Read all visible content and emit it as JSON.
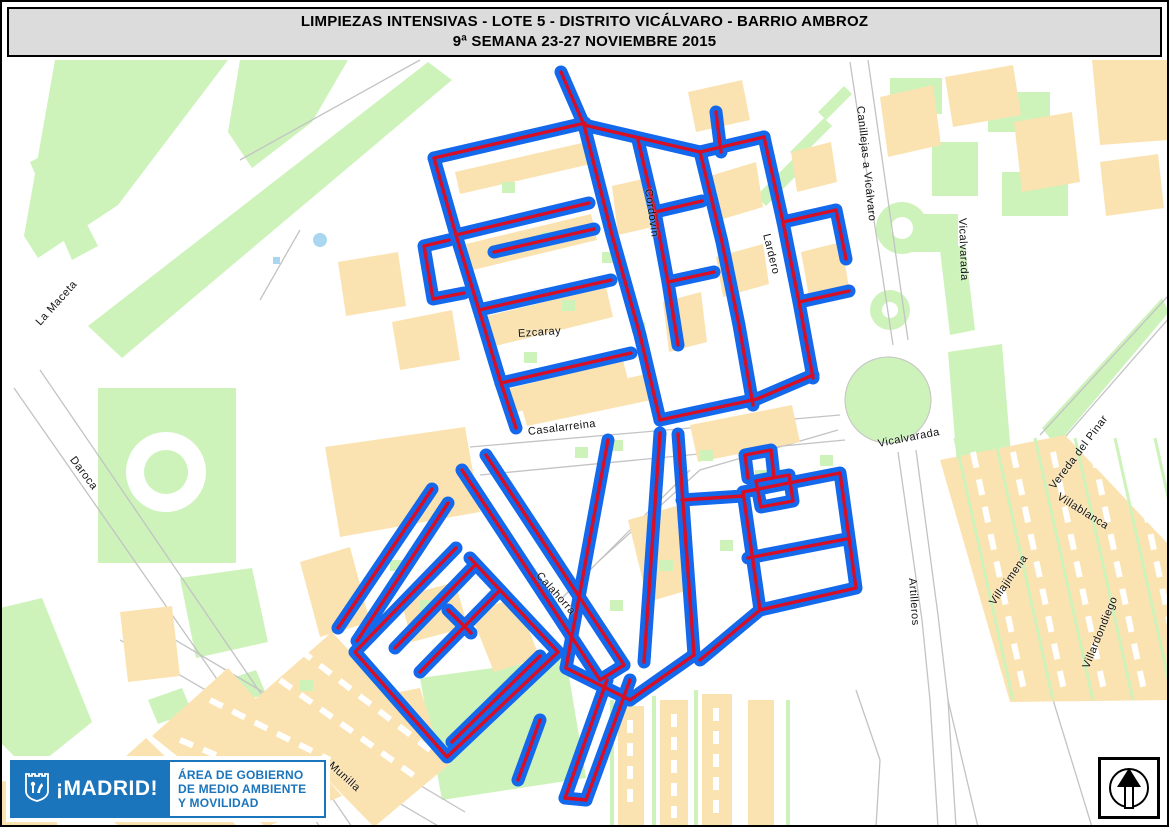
{
  "title": {
    "line1": "LIMPIEZAS INTENSIVAS - LOTE 5 - DISTRITO VICÁLVARO - BARRIO AMBROZ",
    "line2": "9ª SEMANA 23-27 NOVIEMBRE 2015"
  },
  "map": {
    "colors": {
      "route_blue": "#1468ec",
      "route_red": "#d60e26",
      "park_green": "#cdf3bb",
      "building_tan": "#fbe3b1",
      "street_gray": "#c3c3c3",
      "pond_blue": "#a9d7f2"
    },
    "street_labels": [
      {
        "text": "La Maceta",
        "x": 38,
        "y": 318,
        "rot": -48
      },
      {
        "text": "Daroca",
        "x": 72,
        "y": 452,
        "rot": 53
      },
      {
        "text": "Ezcaray",
        "x": 518,
        "y": 328,
        "rot": -4
      },
      {
        "text": "Casalarreina",
        "x": 528,
        "y": 426,
        "rot": -7
      },
      {
        "text": "Cordovín",
        "x": 648,
        "y": 183,
        "rot": 82
      },
      {
        "text": "Lardero",
        "x": 766,
        "y": 228,
        "rot": 76
      },
      {
        "text": "Canillejas a Vicálvaro",
        "x": 860,
        "y": 100,
        "rot": 84
      },
      {
        "text": "Vicalvarada",
        "x": 962,
        "y": 212,
        "rot": 88
      },
      {
        "text": "Vicalvarada",
        "x": 878,
        "y": 438,
        "rot": -11
      },
      {
        "text": "Vereda del Pinar",
        "x": 1052,
        "y": 482,
        "rot": -53
      },
      {
        "text": "Villablanca",
        "x": 1058,
        "y": 490,
        "rot": 32
      },
      {
        "text": "Villajimena",
        "x": 992,
        "y": 598,
        "rot": -55
      },
      {
        "text": "Villardondiego",
        "x": 1086,
        "y": 662,
        "rot": -68
      },
      {
        "text": "Artilleros",
        "x": 912,
        "y": 572,
        "rot": 86
      },
      {
        "text": "Munilla",
        "x": 330,
        "y": 758,
        "rot": 42
      },
      {
        "text": "Calahorra",
        "x": 538,
        "y": 568,
        "rot": 48
      }
    ]
  },
  "footer": {
    "logo_text": "¡MADRID!",
    "dept_line1": "ÁREA DE GOBIERNO",
    "dept_line2": "DE MEDIO AMBIENTE",
    "dept_line3": "Y MOVILIDAD",
    "brand_blue": "#1b75bc"
  }
}
